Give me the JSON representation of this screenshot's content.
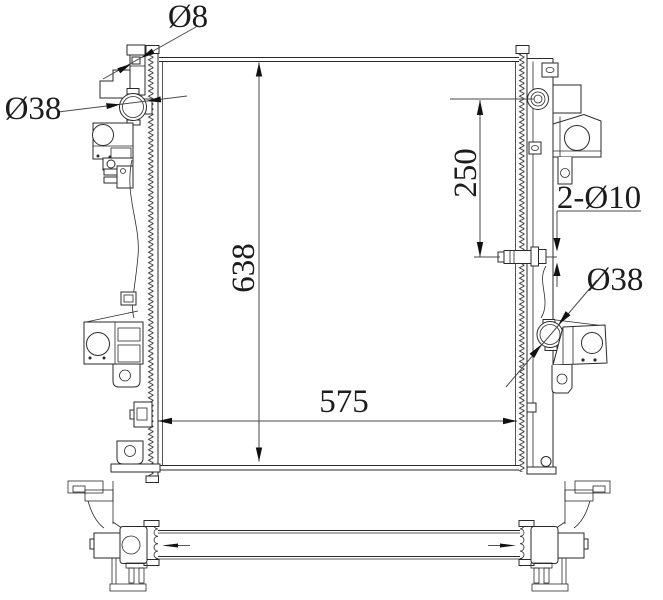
{
  "labels": {
    "dia8": "Ø8",
    "dia38_left": "Ø38",
    "core_height": "638",
    "offset_250": "250",
    "holes_2_dia10": "2-Ø10",
    "dia38_right": "Ø38",
    "core_width": "575"
  },
  "colors": {
    "line": "#2a2a2a",
    "dimension_line": "#4a4a4a",
    "background": "#ffffff"
  }
}
